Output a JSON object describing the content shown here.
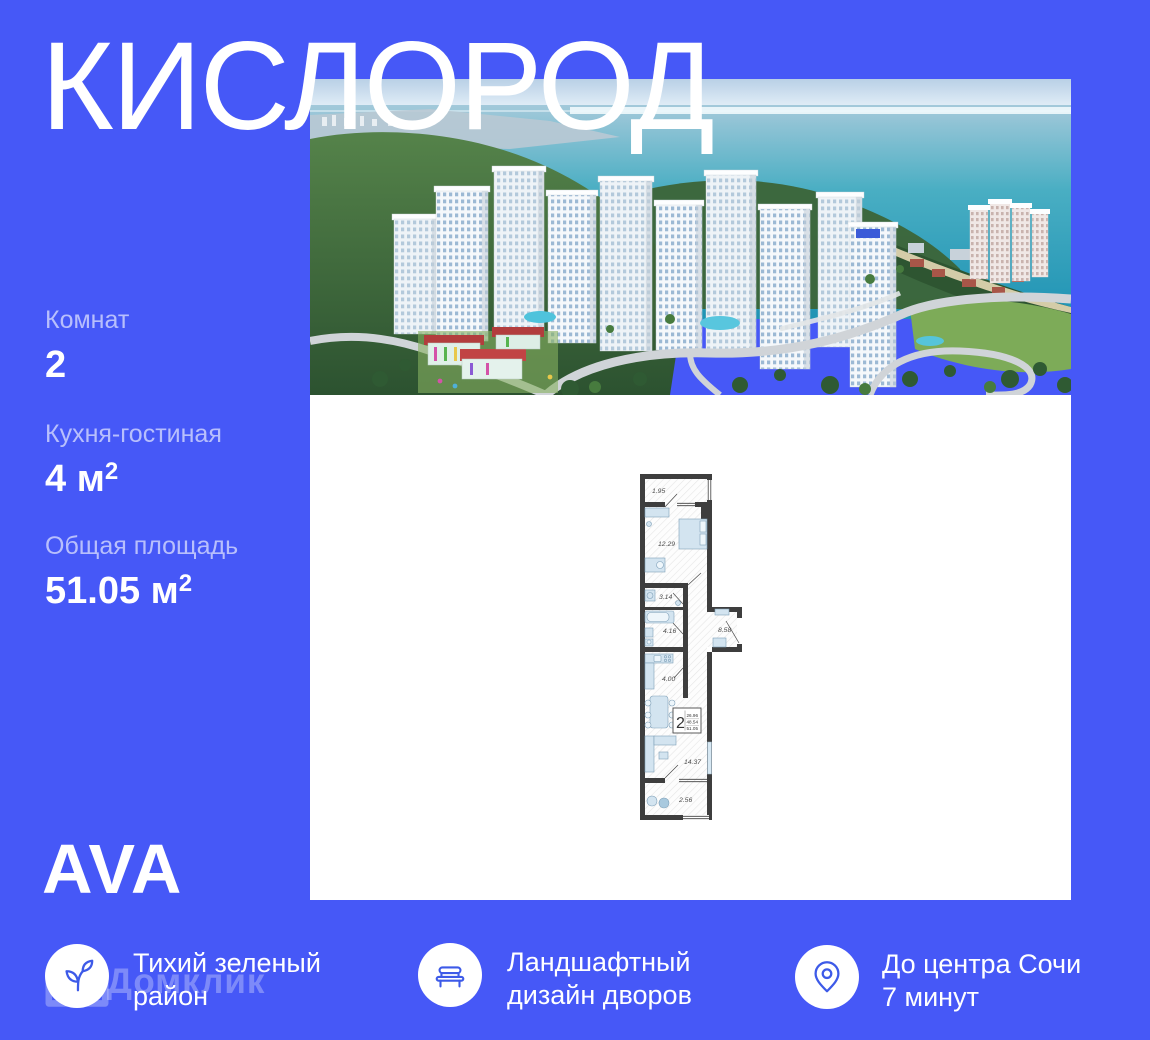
{
  "title": "КИСЛОРОД",
  "colors": {
    "background": "#4658F7",
    "icon_accent": "#3D5AE8",
    "sea": "#2EA3BE",
    "plan_wall": "#3E3E3E"
  },
  "stats": [
    {
      "label": "Комнат",
      "value": "2",
      "sup": ""
    },
    {
      "label": "Кухня-гостиная",
      "value": "4 м",
      "sup": "2"
    },
    {
      "label": "Общая площадь",
      "value": "51.05 м",
      "sup": "2"
    }
  ],
  "logo": "AVA",
  "watermark": "Домклик",
  "floorplan": {
    "rooms": [
      {
        "name": "balcony-top",
        "area": "1.95"
      },
      {
        "name": "bedroom",
        "area": "12.29"
      },
      {
        "name": "bathroom-small",
        "area": "3.14"
      },
      {
        "name": "bathroom",
        "area": "4.16"
      },
      {
        "name": "hallway",
        "area": "8.58"
      },
      {
        "name": "kitchen",
        "area": "4.00"
      },
      {
        "name": "living-room",
        "area": "14.37"
      },
      {
        "name": "balcony-bottom",
        "area": "2.56"
      }
    ],
    "stamp": {
      "rooms": "2",
      "line1": "26.96",
      "line2": "48.54",
      "line3": "51.05"
    }
  },
  "features": [
    {
      "icon": "sprout-icon",
      "line1": "Тихий зеленый",
      "line2": "район"
    },
    {
      "icon": "bench-icon",
      "line1": "Ландшафтный",
      "line2": "дизайн дворов"
    },
    {
      "icon": "map-pin-icon",
      "line1": "До центра Сочи",
      "line2": "7 минут"
    }
  ]
}
